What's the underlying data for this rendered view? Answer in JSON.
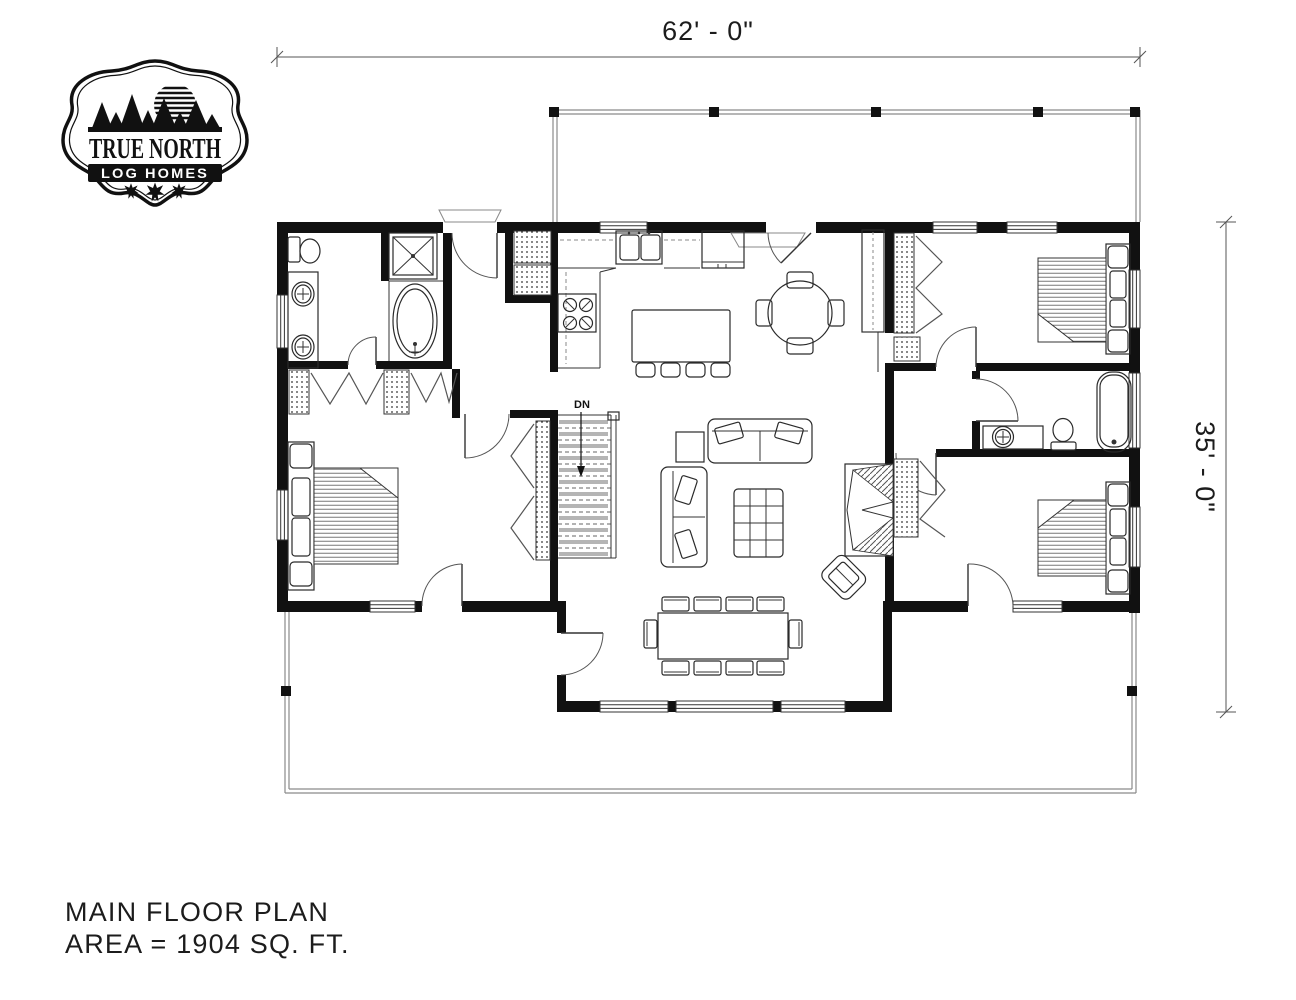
{
  "logo": {
    "name": "True North Log Homes badge",
    "line1": "TRUE NORTH",
    "line2": "LOG HOMES"
  },
  "dimensions": {
    "width_label": "62' - 0\"",
    "height_label": "35' - 0\""
  },
  "floor_plan": {
    "stairs_label": "DN"
  },
  "title_block": {
    "line1": "MAIN FLOOR PLAN",
    "line2": "AREA = 1904 SQ. FT."
  },
  "colors": {
    "ink": "#111111",
    "wall": "#111111",
    "dimension": "#555555",
    "background": "#ffffff"
  }
}
